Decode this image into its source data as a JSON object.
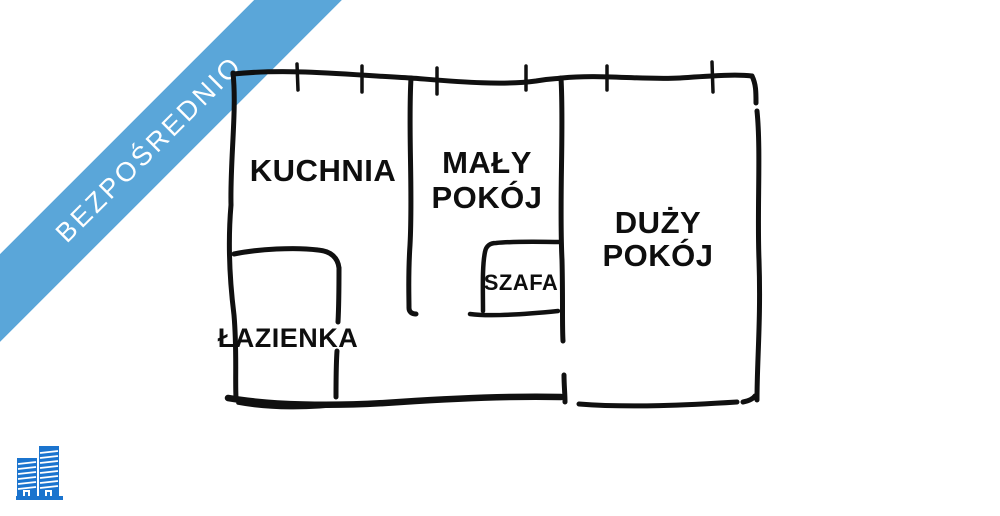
{
  "banner": {
    "label": "BEZPOŚREDNIO",
    "bg_color": "#5AA6D9",
    "text_color": "#FFFFFF"
  },
  "floorplan": {
    "wall_color": "#101010",
    "label_color": "#0E0E0E",
    "labels": {
      "kuchnia": "KUCHNIA",
      "maly_line1": "MAŁY",
      "maly_line2": "POKÓJ",
      "duzy_line1": "DUŻY",
      "duzy_line2": "POKÓJ",
      "szafa": "SZAFA",
      "lazienka": "ŁAZIENKA"
    }
  },
  "logo": {
    "icon": "buildings-icon",
    "color": "#1B74CE"
  }
}
